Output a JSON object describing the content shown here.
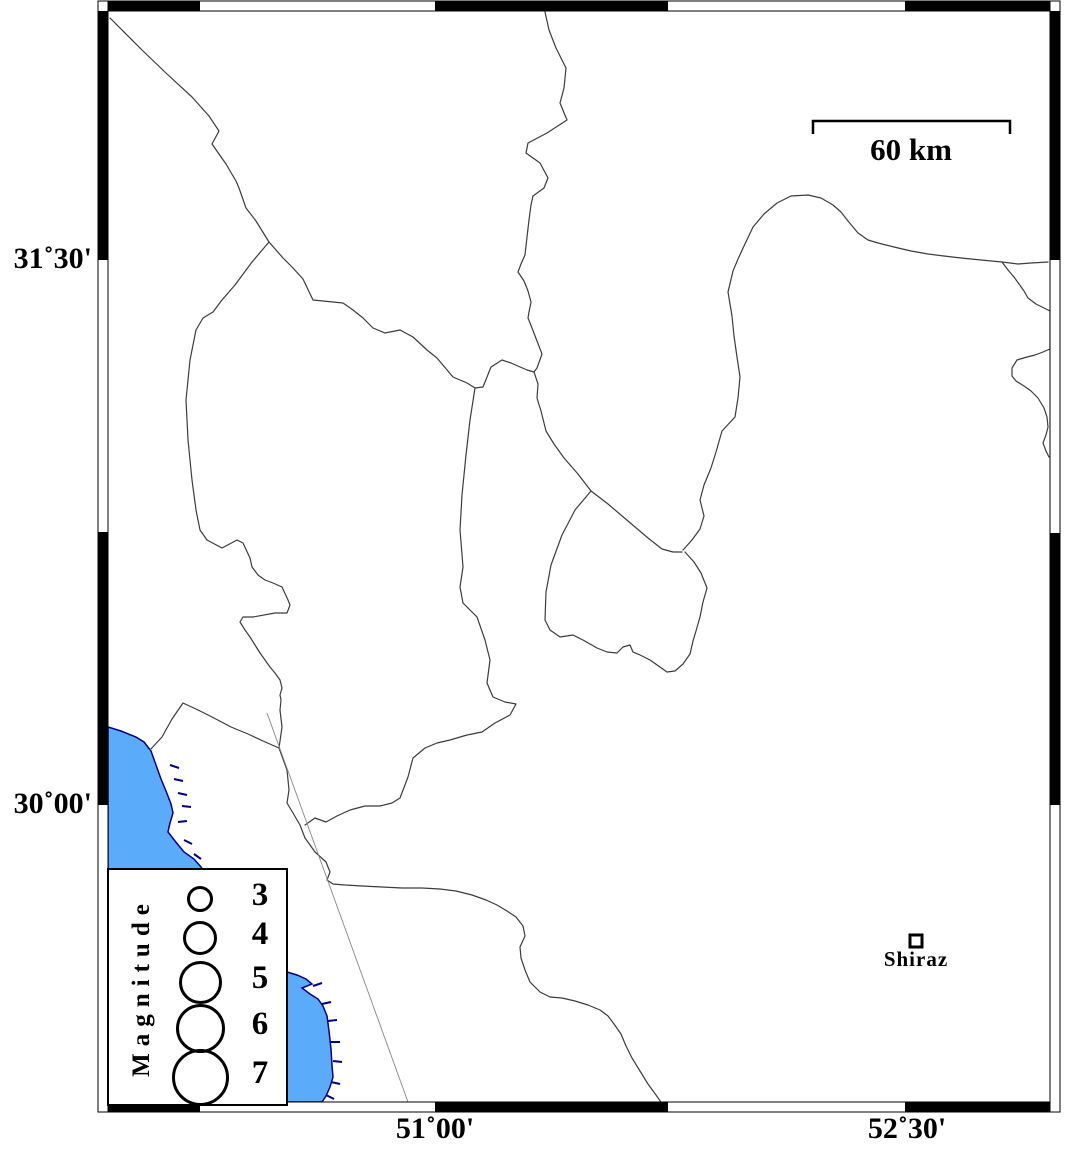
{
  "map": {
    "axis_labels": {
      "left": [
        {
          "text": "31˚30'"
        },
        {
          "text": "30˚00'"
        }
      ],
      "bottom": [
        {
          "text": "51˚00'"
        },
        {
          "text": "52˚30'"
        }
      ]
    },
    "scale_bar": {
      "label": "60 km"
    },
    "city": {
      "name": "Shiraz"
    },
    "legend": {
      "title": "Magnitude",
      "items": [
        {
          "magnitude": "3",
          "diameter": 20
        },
        {
          "magnitude": "4",
          "diameter": 28
        },
        {
          "magnitude": "5",
          "diameter": 37
        },
        {
          "magnitude": "6",
          "diameter": 43
        },
        {
          "magnitude": "7",
          "diameter": 51
        }
      ]
    },
    "colors": {
      "water": "#5AACFA",
      "coastline": "#000080",
      "boundary": "#3C3C3C",
      "fault": "#888888",
      "frame": "#000000"
    }
  }
}
